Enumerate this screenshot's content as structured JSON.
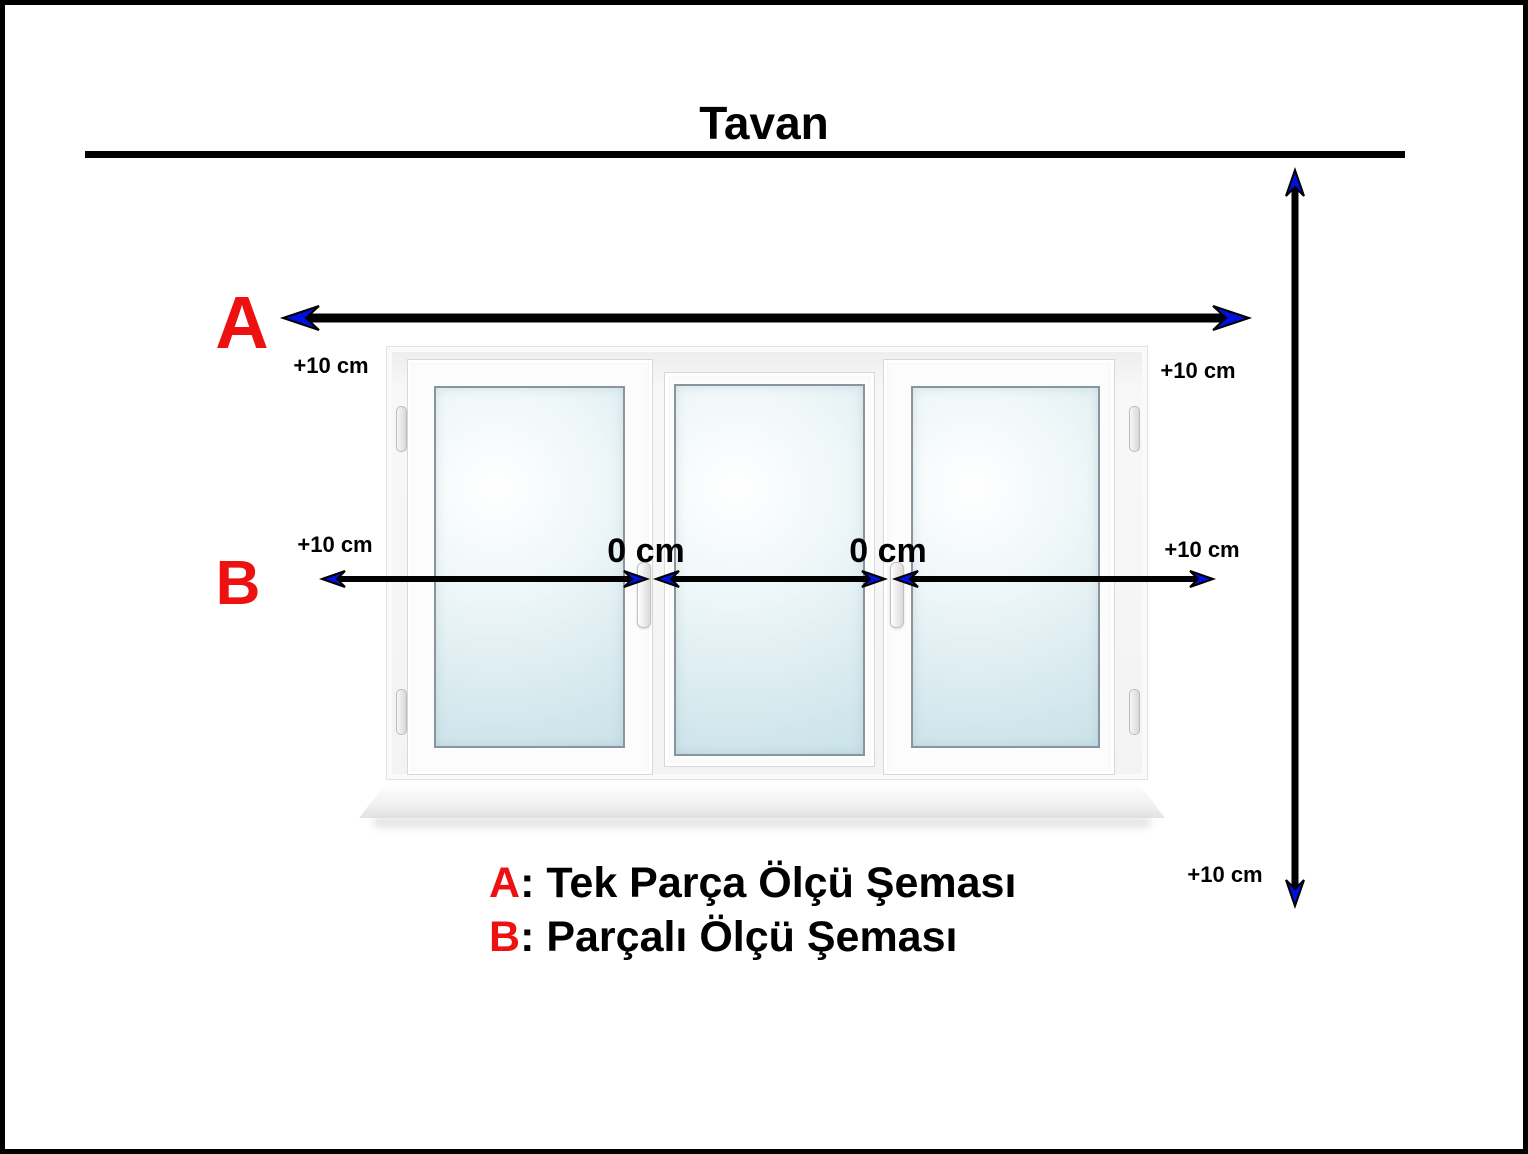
{
  "title": "Tavan",
  "colors": {
    "marker_red": "#ee1111",
    "arrow_blue": "#0011dd",
    "line_black": "#000000"
  },
  "markers": {
    "a": "A",
    "b": "B"
  },
  "measurements": {
    "a_left": "+10 cm",
    "a_right": "+10 cm",
    "b_left": "+10 cm",
    "b_right": "+10 cm",
    "vertical_bottom": "+10 cm",
    "gap_1": "0 cm",
    "gap_2": "0 cm"
  },
  "legend": {
    "a_key": "A",
    "a_text": ": Tek Parça Ölçü Şeması",
    "b_key": "B",
    "b_text": ": Parçalı Ölçü Şeması"
  }
}
